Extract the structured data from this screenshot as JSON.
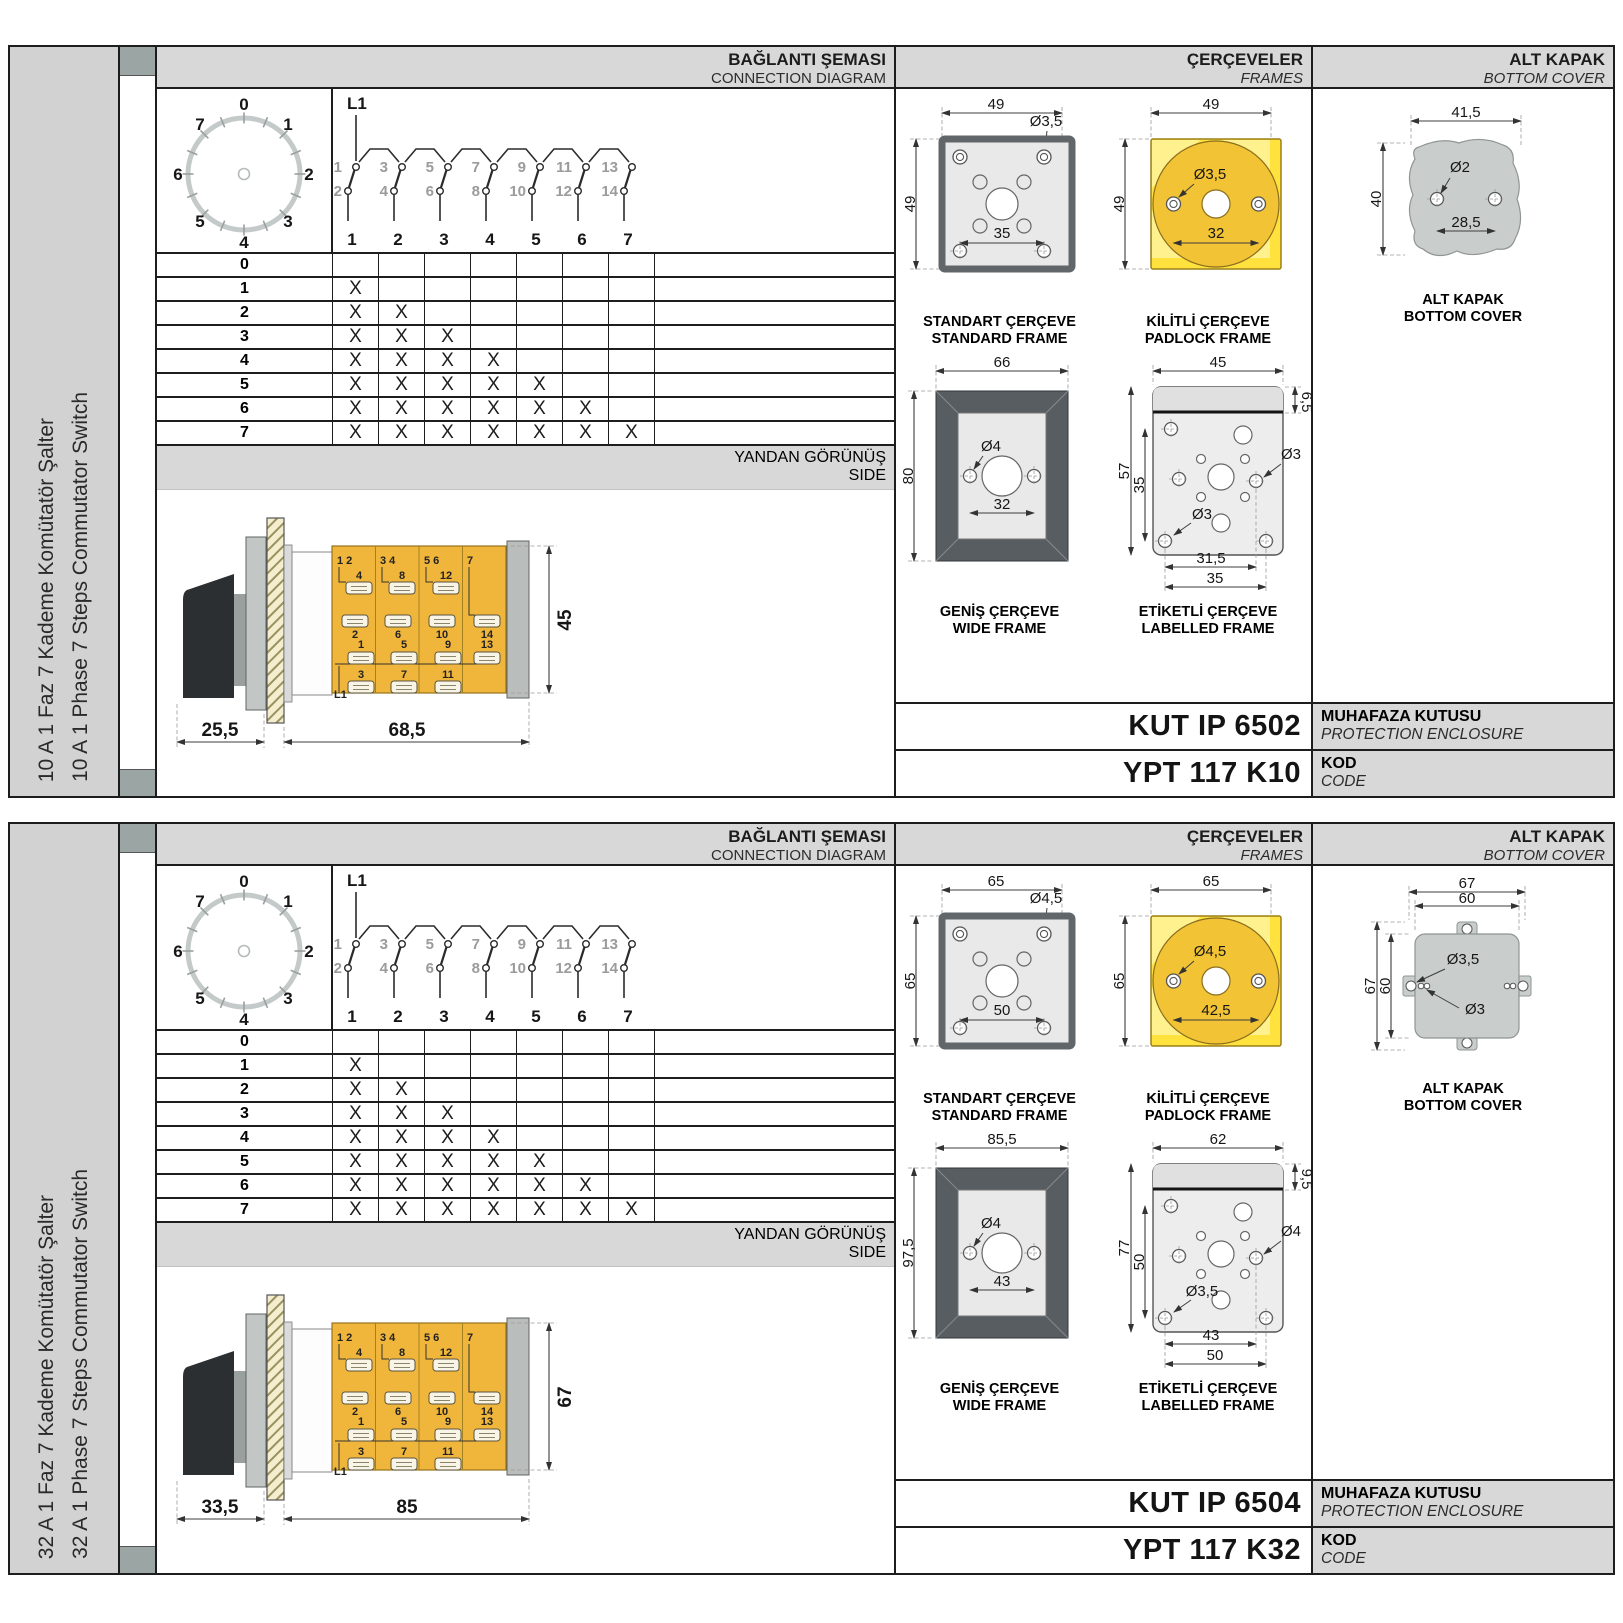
{
  "colors": {
    "body_yellow": "#f0b53b",
    "padlock_yellow": "#ffe23e",
    "padlock_circle": "#f2c335",
    "frame_gray": "#e9e9e9",
    "wide_border": "#585d61",
    "cover_gray": "#c9cecd",
    "band_gray": "#d8d8d8",
    "sidebar_gray": "#d2d2d2",
    "accent_square": "#9ba5a3"
  },
  "panels": [
    {
      "sidebar": {
        "tr": "10 A 1 Faz 7 Kademe Komütatör Şalter",
        "en": "10 A 1 Phase 7 Steps Commutator Switch"
      },
      "conn": {
        "band_tr": "BAĞLANTI ŞEMASI",
        "band_en": "CONNECTION DIAGRAM",
        "dial": {
          "n0": "0",
          "n1": "1",
          "n2": "2",
          "n3": "3",
          "n4": "4",
          "n5": "5",
          "n6": "6",
          "n7": "7"
        },
        "schem": {
          "l1": "L1",
          "upper": [
            "1",
            "3",
            "5",
            "7",
            "9",
            "11",
            "13"
          ],
          "lower": [
            "2",
            "4",
            "6",
            "8",
            "10",
            "12",
            "14"
          ],
          "cols": [
            "1",
            "2",
            "3",
            "4",
            "5",
            "6",
            "7"
          ]
        },
        "table": [
          {
            "label": "0",
            "cells": [
              "",
              "",
              "",
              "",
              "",
              "",
              ""
            ]
          },
          {
            "label": "1",
            "cells": [
              "X",
              "",
              "",
              "",
              "",
              "",
              ""
            ]
          },
          {
            "label": "2",
            "cells": [
              "X",
              "X",
              "",
              "",
              "",
              "",
              ""
            ]
          },
          {
            "label": "3",
            "cells": [
              "X",
              "X",
              "X",
              "",
              "",
              "",
              ""
            ]
          },
          {
            "label": "4",
            "cells": [
              "X",
              "X",
              "X",
              "X",
              "",
              "",
              ""
            ]
          },
          {
            "label": "5",
            "cells": [
              "X",
              "X",
              "X",
              "X",
              "X",
              "",
              ""
            ]
          },
          {
            "label": "6",
            "cells": [
              "X",
              "X",
              "X",
              "X",
              "X",
              "X",
              ""
            ]
          },
          {
            "label": "7",
            "cells": [
              "X",
              "X",
              "X",
              "X",
              "X",
              "X",
              "X"
            ]
          }
        ]
      },
      "side": {
        "band_tr": "YANDAN GÖRÜNÜŞ",
        "band_en": "SIDE",
        "l1": "L1",
        "sec1": {
          "pair": "1 2",
          "a": "4",
          "b": "2",
          "c": "1",
          "d": "3"
        },
        "sec2": {
          "pair": "3 4",
          "a": "8",
          "b": "6",
          "c": "5",
          "d": "7"
        },
        "sec3": {
          "pair": "5 6",
          "a": "12",
          "b": "10",
          "c": "9",
          "d": "11"
        },
        "sec4": {
          "pair": "7",
          "b": "14",
          "c": "13"
        },
        "dims": {
          "front": "25,5",
          "body": "68,5",
          "height": "45"
        }
      },
      "frames": {
        "band_tr": "ÇERÇEVELER",
        "band_en": "FRAMES",
        "standard": {
          "tr": "STANDART ÇERÇEVE",
          "en": "STANDARD FRAME",
          "w": "49",
          "h": "49",
          "hole": "Ø3,5",
          "span": "35"
        },
        "padlock": {
          "tr": "KİLİTLİ ÇERÇEVE",
          "en": "PADLOCK FRAME",
          "w": "49",
          "h": "49",
          "hole": "Ø3,5",
          "span": "32"
        },
        "wide": {
          "tr": "GENİŞ ÇERÇEVE",
          "en": "WIDE FRAME",
          "w": "66",
          "h": "80",
          "hole": "Ø4",
          "span": "32"
        },
        "labelled": {
          "tr": "ETİKETLİ ÇERÇEVE",
          "en": "LABELLED FRAME",
          "w": "45",
          "band": "6,5",
          "h": "57",
          "ih": "35",
          "s1": "31,5",
          "s2": "35",
          "hole1": "Ø3",
          "hole2": "Ø3"
        }
      },
      "cover": {
        "band_tr": "ALT KAPAK",
        "band_en": "BOTTOM COVER",
        "cap_tr": "ALT KAPAK",
        "cap_en": "BOTTOM COVER",
        "w": "41,5",
        "h": "40",
        "hole": "Ø2",
        "span": "28,5"
      },
      "codes": {
        "enc_val": "KUT IP 6502",
        "enc_tr": "MUHAFAZA KUTUSU",
        "enc_en": "PROTECTION ENCLOSURE",
        "code_val": "YPT 117 K10",
        "code_tr": "KOD",
        "code_en": "CODE"
      }
    },
    {
      "sidebar": {
        "tr": "32 A 1 Faz 7 Kademe Komütatör Şalter",
        "en": "32 A 1 Phase 7 Steps Commutator Switch"
      },
      "conn": {
        "band_tr": "BAĞLANTI ŞEMASI",
        "band_en": "CONNECTION DIAGRAM",
        "dial": {
          "n0": "0",
          "n1": "1",
          "n2": "2",
          "n3": "3",
          "n4": "4",
          "n5": "5",
          "n6": "6",
          "n7": "7"
        },
        "schem": {
          "l1": "L1",
          "upper": [
            "1",
            "3",
            "5",
            "7",
            "9",
            "11",
            "13"
          ],
          "lower": [
            "2",
            "4",
            "6",
            "8",
            "10",
            "12",
            "14"
          ],
          "cols": [
            "1",
            "2",
            "3",
            "4",
            "5",
            "6",
            "7"
          ]
        },
        "table": [
          {
            "label": "0",
            "cells": [
              "",
              "",
              "",
              "",
              "",
              "",
              ""
            ]
          },
          {
            "label": "1",
            "cells": [
              "X",
              "",
              "",
              "",
              "",
              "",
              ""
            ]
          },
          {
            "label": "2",
            "cells": [
              "X",
              "X",
              "",
              "",
              "",
              "",
              ""
            ]
          },
          {
            "label": "3",
            "cells": [
              "X",
              "X",
              "X",
              "",
              "",
              "",
              ""
            ]
          },
          {
            "label": "4",
            "cells": [
              "X",
              "X",
              "X",
              "X",
              "",
              "",
              ""
            ]
          },
          {
            "label": "5",
            "cells": [
              "X",
              "X",
              "X",
              "X",
              "X",
              "",
              ""
            ]
          },
          {
            "label": "6",
            "cells": [
              "X",
              "X",
              "X",
              "X",
              "X",
              "X",
              ""
            ]
          },
          {
            "label": "7",
            "cells": [
              "X",
              "X",
              "X",
              "X",
              "X",
              "X",
              "X"
            ]
          }
        ]
      },
      "side": {
        "band_tr": "YANDAN GÖRÜNÜŞ",
        "band_en": "SIDE",
        "l1": "L1",
        "sec1": {
          "pair": "1 2",
          "a": "4",
          "b": "2",
          "c": "1",
          "d": "3"
        },
        "sec2": {
          "pair": "3 4",
          "a": "8",
          "b": "6",
          "c": "5",
          "d": "7"
        },
        "sec3": {
          "pair": "5 6",
          "a": "12",
          "b": "10",
          "c": "9",
          "d": "11"
        },
        "sec4": {
          "pair": "7",
          "b": "14",
          "c": "13"
        },
        "dims": {
          "front": "33,5",
          "body": "85",
          "height": "67"
        }
      },
      "frames": {
        "band_tr": "ÇERÇEVELER",
        "band_en": "FRAMES",
        "standard": {
          "tr": "STANDART ÇERÇEVE",
          "en": "STANDARD FRAME",
          "w": "65",
          "h": "65",
          "hole": "Ø4,5",
          "span": "50"
        },
        "padlock": {
          "tr": "KİLİTLİ ÇERÇEVE",
          "en": "PADLOCK FRAME",
          "w": "65",
          "h": "65",
          "hole": "Ø4,5",
          "span": "42,5"
        },
        "wide": {
          "tr": "GENİŞ ÇERÇEVE",
          "en": "WIDE FRAME",
          "w": "85,5",
          "h": "97,5",
          "hole": "Ø4",
          "span": "43"
        },
        "labelled": {
          "tr": "ETİKETLİ ÇERÇEVE",
          "en": "LABELLED FRAME",
          "w": "62",
          "band": "9,5",
          "h": "77",
          "ih": "50",
          "s1": "43",
          "s2": "50",
          "hole1": "Ø3,5",
          "hole2": "Ø4"
        }
      },
      "cover": {
        "band_tr": "ALT KAPAK",
        "band_en": "BOTTOM COVER",
        "cap_tr": "ALT KAPAK",
        "cap_en": "BOTTOM COVER",
        "wo": "67",
        "wi": "60",
        "ho": "67",
        "hi": "60",
        "hole1": "Ø3,5",
        "hole2": "Ø3"
      },
      "codes": {
        "enc_val": "KUT IP 6504",
        "enc_tr": "MUHAFAZA KUTUSU",
        "enc_en": "PROTECTION ENCLOSURE",
        "code_val": "YPT 117 K32",
        "code_tr": "KOD",
        "code_en": "CODE"
      }
    }
  ]
}
